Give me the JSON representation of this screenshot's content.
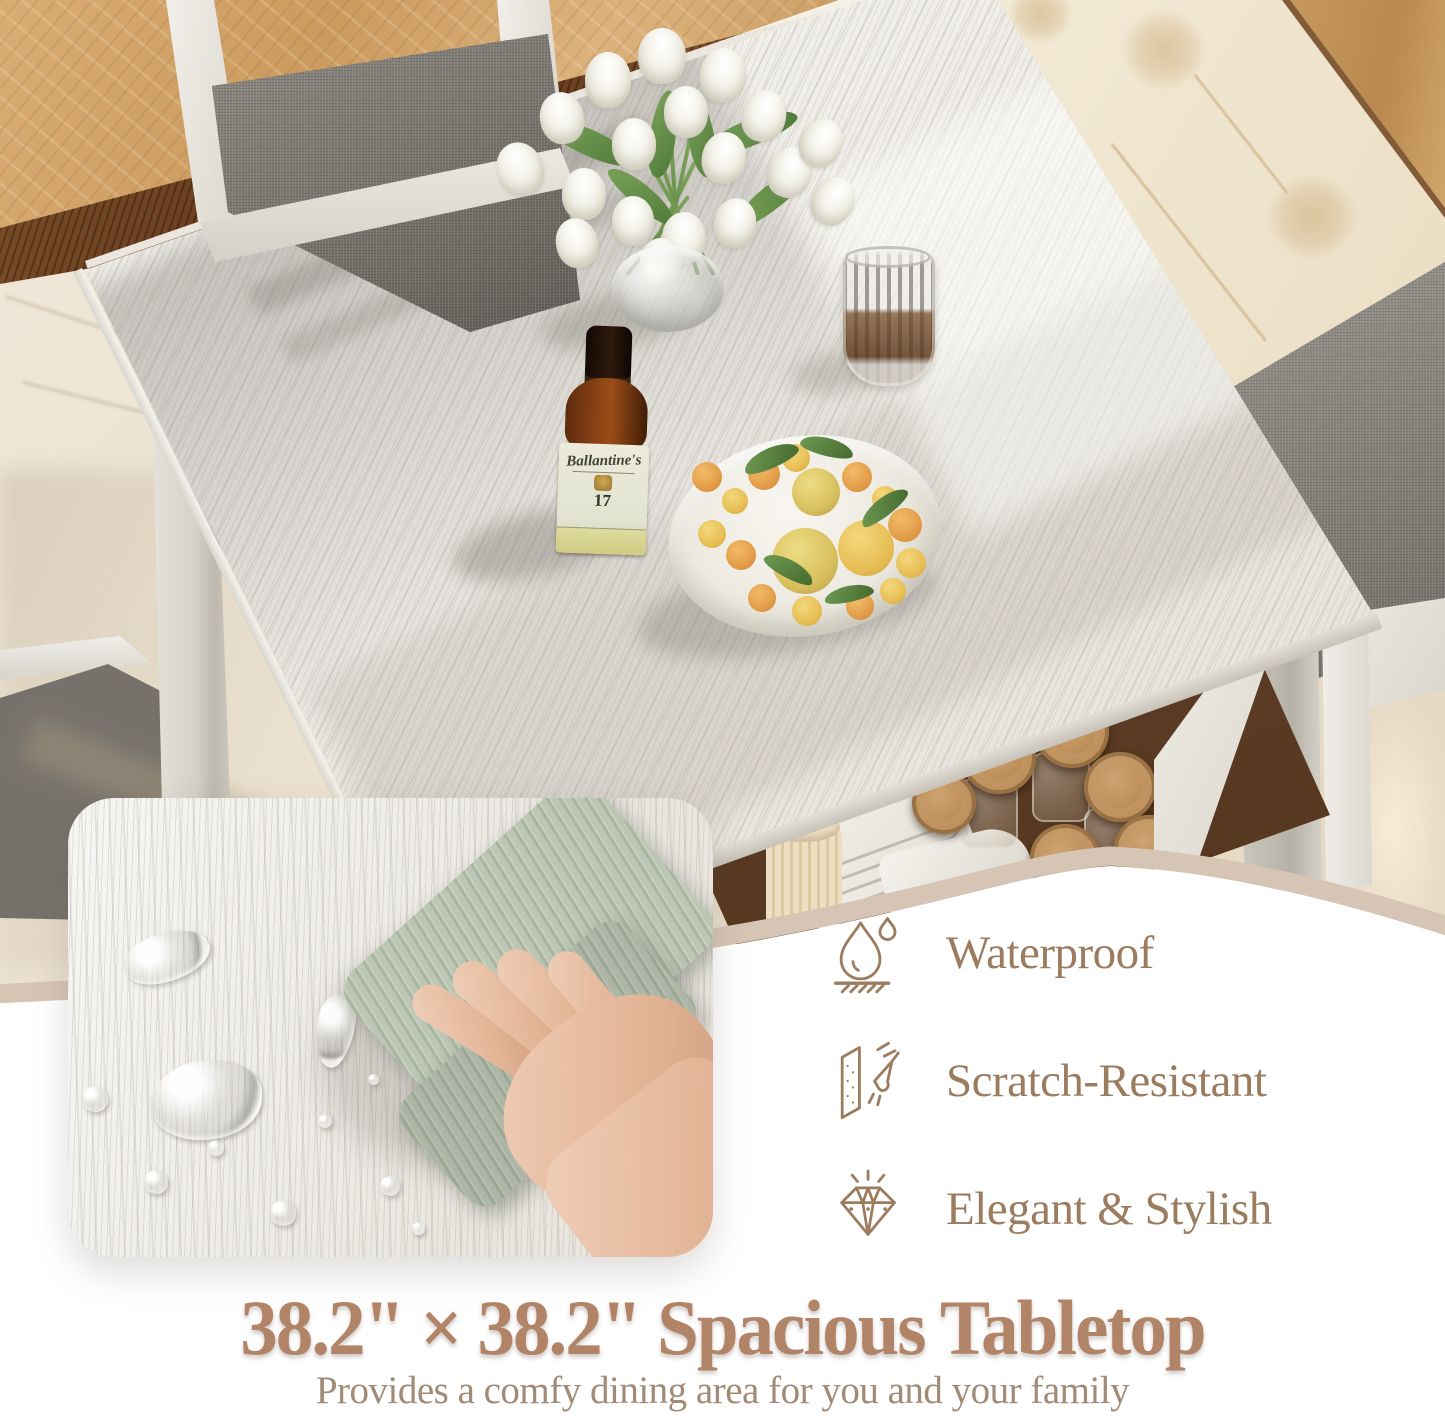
{
  "headline": {
    "title": "38.2\" × 38.2\" Spacious Tabletop",
    "subtitle": "Provides a comfy dining area for you and your family"
  },
  "features": {
    "items": [
      {
        "icon": "water-drop-icon",
        "label": "Waterproof"
      },
      {
        "icon": "scratch-resistant-icon",
        "label": "Scratch-Resistant"
      },
      {
        "icon": "diamond-icon",
        "label": "Elegant & Stylish"
      }
    ]
  },
  "photo": {
    "bottle": {
      "brand": "Ballantine's",
      "age": "17"
    }
  },
  "colors": {
    "headline_text": "#b18367",
    "feature_text": "#9c7c5f",
    "icon_stroke": "#9c7c5f",
    "curve_band": "#d6c5b5",
    "background": "#ffffff"
  }
}
